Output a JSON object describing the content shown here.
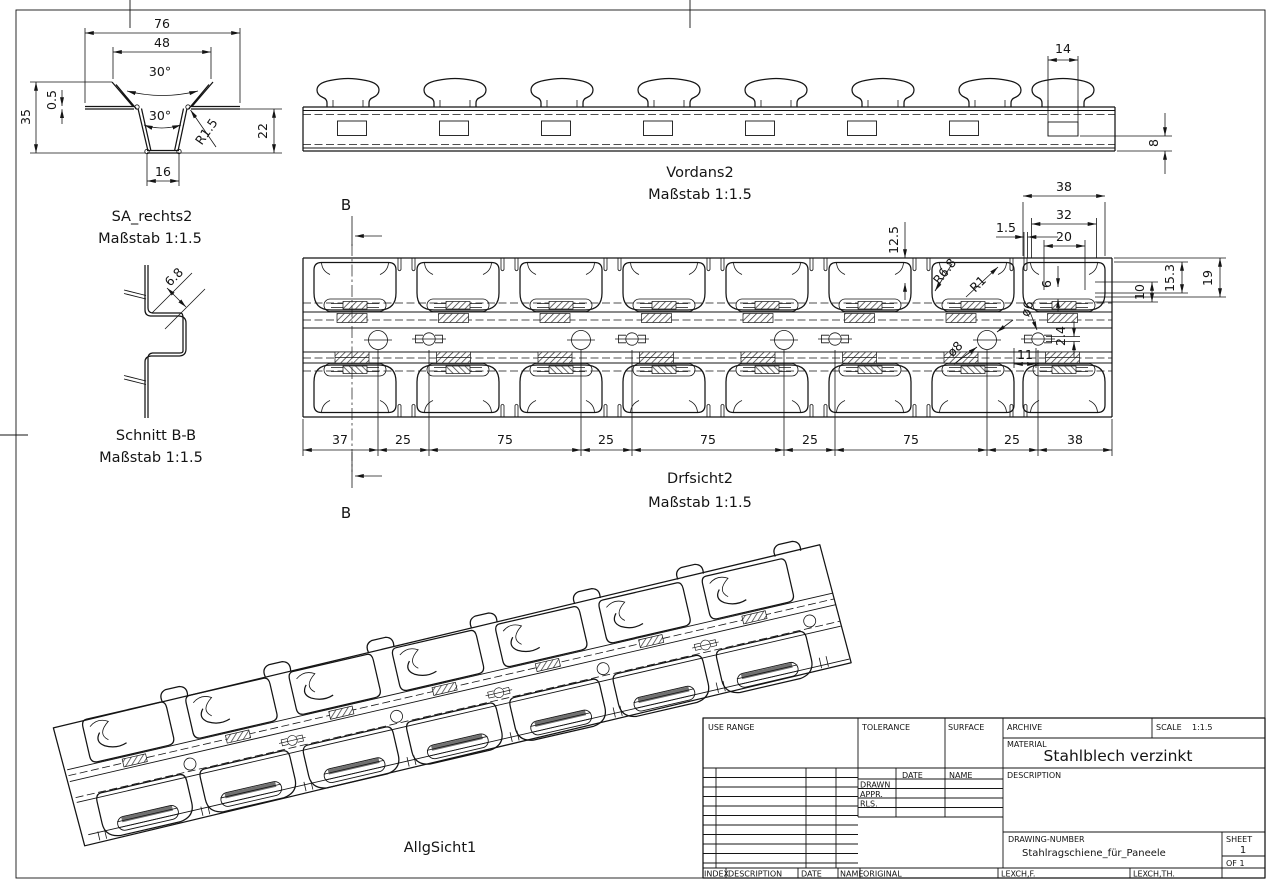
{
  "page": {
    "bg": "#ffffff",
    "line_color": "#141414"
  },
  "views": {
    "sa_rechts2": {
      "title": "SA_rechts2",
      "scale": "Maßstab 1:1.5",
      "dims": {
        "w76": "76",
        "w48": "48",
        "ang_top": "30°",
        "ang_bottom": "30°",
        "t05": "0.5",
        "h35": "35",
        "r15": "R1.5",
        "h22": "22",
        "w16": "16"
      }
    },
    "vordans2": {
      "title": "Vordans2",
      "scale": "Maßstab 1:1.5",
      "dims": {
        "w14": "14",
        "h8": "8"
      }
    },
    "schnitt_bb": {
      "title": "Schnitt B-B",
      "scale": "Maßstab 1:1.5",
      "dims": {
        "w68": "6.8"
      }
    },
    "drfsicht2": {
      "title": "Drfsicht2",
      "scale": "Maßstab 1:1.5",
      "marker_b": "B",
      "dims": {
        "w38": "38",
        "w32": "32",
        "w20": "20",
        "w15": "1.5",
        "h125": "12.5",
        "h6": "6",
        "h10": "10",
        "h153": "15.3",
        "h19": "19",
        "r68": "R6.8",
        "r1": "R1",
        "d8": "ø8",
        "d6": "ø6",
        "h24": "2.4",
        "w11": "11"
      },
      "chain": [
        "37",
        "25",
        "75",
        "25",
        "75",
        "25",
        "75",
        "25",
        "38"
      ]
    },
    "allgsicht1": {
      "title": "AllgSicht1"
    }
  },
  "title_block": {
    "use_range": "USE RANGE",
    "tolerance": "TOLERANCE",
    "surface": "SURFACE",
    "archive": "ARCHIVE",
    "scale_label": "SCALE",
    "scale_value": "1:1.5",
    "material_label": "MATERIAL",
    "material_value": "Stahlblech verzinkt",
    "description_label": "DESCRIPTION",
    "date_label": "DATE",
    "name_label": "NAME",
    "drawn_label": "DRAWN",
    "appr_label": "APPR.",
    "rls_label": "RLS.",
    "drawing_number_label": "DRAWING-NUMBER",
    "drawing_number_value": "Stahlragschiene_für_Paneele",
    "sheet_label": "SHEET",
    "sheet_value": "1",
    "of_value": "OF 1",
    "index_label": "INDEX",
    "description2_label": "DESCRIPTION",
    "date2_label": "DATE",
    "name2_label": "NAME",
    "original_label": "ORIGINAL",
    "check1": "LEXCH,F.",
    "check2": "LEXCH,TH."
  }
}
